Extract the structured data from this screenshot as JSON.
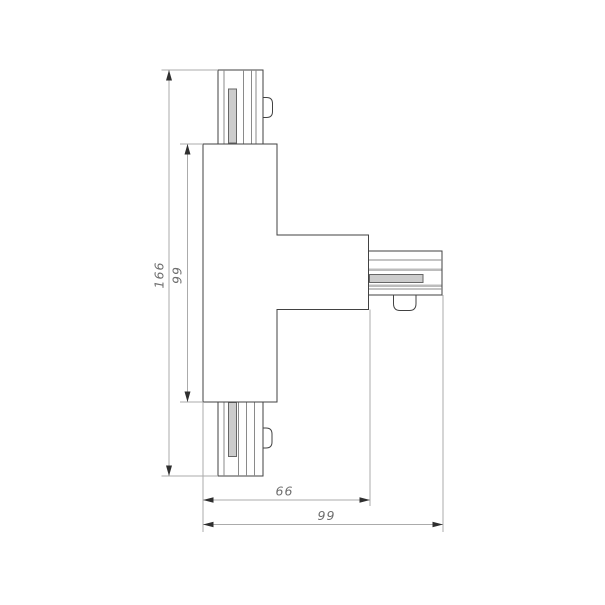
{
  "drawing": {
    "title": "t-connector-dimension-drawing",
    "subject": "T-shaped track connector, plan view with dimension lines",
    "dimensions": {
      "overall_height": "166",
      "body_height": "99",
      "body_to_arm_end_width": "66",
      "overall_width": "99"
    },
    "colors": {
      "background": "#ffffff",
      "object_line": "#424242",
      "rib_line": "#8a8a8a",
      "slot_fill": "#cccccc",
      "slot_outline": "#666666",
      "band_fill": "#bcbcbc",
      "dim_line": "#ababab",
      "arrow": "#2f2f2f",
      "dim_text": "#6e6e6e"
    }
  }
}
